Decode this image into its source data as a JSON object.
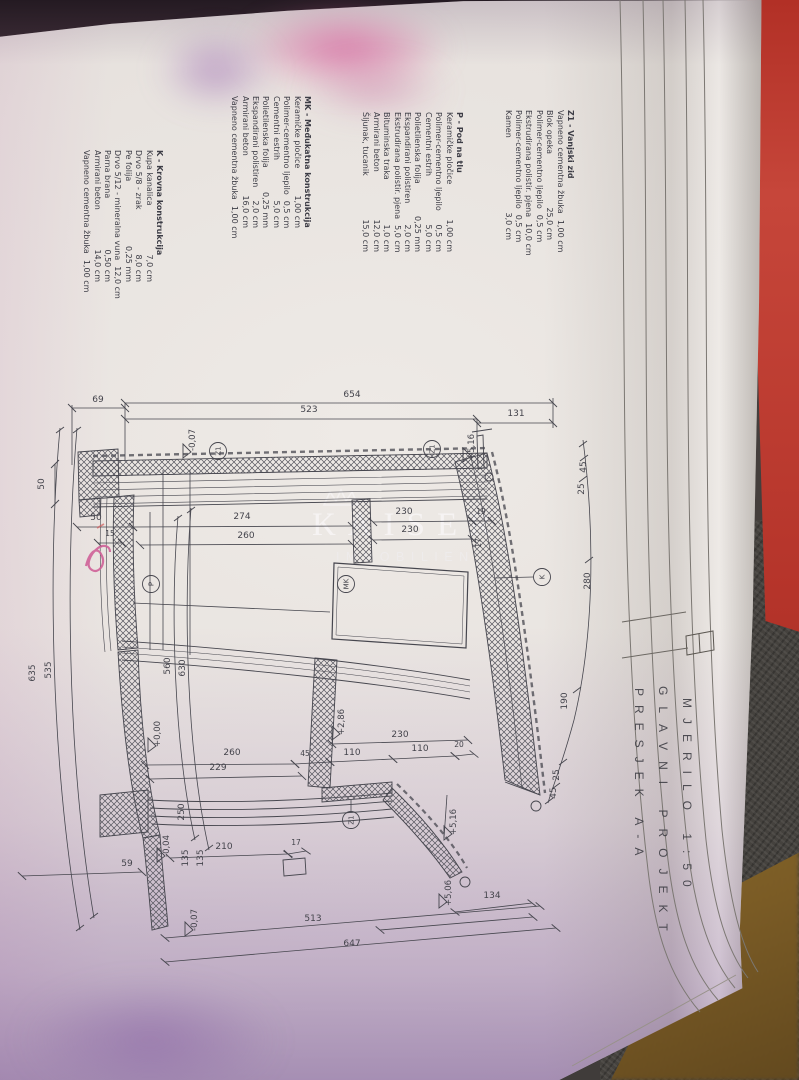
{
  "title_block": {
    "line1": "PRESJEK A-A",
    "line2": "GLAVNI PROJEKT",
    "line3": "MJERILO 1:50"
  },
  "watermark": {
    "line1": "KAISER",
    "line2": "IMMOBILIEN"
  },
  "annotations": {
    "handwritten_mark": "pink pen squiggle",
    "ink_color": "#cf6098"
  },
  "colors": {
    "paper": "#e9e5e1",
    "line": "#46464e",
    "cover_red": "#b5342a",
    "carpet": "#45423e",
    "fabric": "#8a672a"
  },
  "legend": {
    "blocks": [
      {
        "id": "k",
        "header": "K - Krovna konstrukcija",
        "items": [
          [
            "Kupa kanalica",
            "7,0 cm"
          ],
          [
            "Drvo 5/8 - zrak",
            "8,0 cm"
          ],
          [
            "Pe folija",
            "0,25 mm"
          ],
          [
            "Drvo 5/12 - mineralna vuna",
            "12,0 cm"
          ],
          [
            "Parna brana",
            "0,50 cm"
          ],
          [
            "Armirani beton",
            "14,0 cm"
          ],
          [
            "Vapneno cementna žbuka",
            "1,00 cm"
          ]
        ]
      },
      {
        "id": "mk",
        "header": "MK - Međukatna konstrukcija",
        "items": [
          [
            "Keramičke pločice",
            "1,00 cm"
          ],
          [
            "Polimer-cementno ljepilo",
            "0,5 cm"
          ],
          [
            "Cementni estrih",
            "5,0 cm"
          ],
          [
            "Polietilenska folija",
            "0,25 mm"
          ],
          [
            "Ekspandirani polistiren",
            "2,0 cm"
          ],
          [
            "Armirani beton",
            "16,0 cm"
          ],
          [
            "Vapneno cementna žbuka",
            "1,00 cm"
          ]
        ]
      },
      {
        "id": "p",
        "header": "P - Pod na tlu",
        "items": [
          [
            "Keramičke pločice",
            "1,00 cm"
          ],
          [
            "Polimer-cementno ljepilo",
            "0,5 cm"
          ],
          [
            "Cementni estrih",
            "5,0 cm"
          ],
          [
            "Polietilenska folija",
            "0,25 mm"
          ],
          [
            "Ekspandirani polistiren",
            "2,0 cm"
          ],
          [
            "Ekstrudirana polistir. pjena",
            "5,0 cm"
          ],
          [
            "Bituminska traka",
            "1,0 cm"
          ],
          [
            "Armirani beton",
            "12,0 cm"
          ],
          [
            "Šljunak, tucanik",
            "15,0 cm"
          ]
        ]
      },
      {
        "id": "z1",
        "header": "Z1 - Vanjski zid",
        "items": [
          [
            "Vapneno cementna žbuka",
            "1,00 cm"
          ],
          [
            "Blok opeka",
            "25,0 cm"
          ],
          [
            "Polimer-cementno ljepilo",
            "0,5 cm"
          ],
          [
            "Ekstrudirana polistir. pjena",
            "10,0 cm"
          ],
          [
            "Polimer-cementno ljepilo",
            "0,5 cm"
          ],
          [
            "Kamen",
            "3,0 cm"
          ]
        ]
      }
    ]
  },
  "drawing": {
    "markers": [
      {
        "t": "Z1",
        "x": 218,
        "y": 451
      },
      {
        "t": "Z1",
        "x": 432,
        "y": 449
      },
      {
        "t": "Z1",
        "x": 351,
        "y": 820
      },
      {
        "t": "P",
        "x": 151,
        "y": 584
      },
      {
        "t": "MK",
        "x": 346,
        "y": 584
      },
      {
        "t": "K",
        "x": 542,
        "y": 577
      }
    ],
    "labels": [
      {
        "t": "654",
        "x": 352,
        "y": 397,
        "r": 0
      },
      {
        "t": "69",
        "x": 98,
        "y": 402,
        "r": 0
      },
      {
        "t": "523",
        "x": 309,
        "y": 412,
        "r": 0
      },
      {
        "t": "131",
        "x": 516,
        "y": 416,
        "r": 0
      },
      {
        "t": "50",
        "x": 96,
        "y": 520,
        "r": 0
      },
      {
        "t": "274",
        "x": 242,
        "y": 519,
        "r": 0
      },
      {
        "t": "15",
        "x": 110,
        "y": 536,
        "r": 0,
        "fs": 7.5
      },
      {
        "t": "260",
        "x": 246,
        "y": 538,
        "r": 0
      },
      {
        "t": "230",
        "x": 404,
        "y": 514,
        "r": 0
      },
      {
        "t": "19",
        "x": 481,
        "y": 514,
        "r": 0,
        "fs": 7.5
      },
      {
        "t": "230",
        "x": 410,
        "y": 532,
        "r": 0
      },
      {
        "t": "230",
        "x": 400,
        "y": 737,
        "r": 0
      },
      {
        "t": "110",
        "x": 352,
        "y": 755,
        "r": 0
      },
      {
        "t": "110",
        "x": 420,
        "y": 751,
        "r": 0
      },
      {
        "t": "20",
        "x": 459,
        "y": 747,
        "r": 0,
        "fs": 7.5
      },
      {
        "t": "45",
        "x": 305,
        "y": 756,
        "r": 0,
        "fs": 7.5
      },
      {
        "t": "260",
        "x": 232,
        "y": 755,
        "r": 0
      },
      {
        "t": "229",
        "x": 218,
        "y": 770,
        "r": 0
      },
      {
        "t": "210",
        "x": 224,
        "y": 849,
        "r": 0
      },
      {
        "t": "17",
        "x": 296,
        "y": 845,
        "r": 0,
        "fs": 7.5
      },
      {
        "t": "59",
        "x": 127,
        "y": 866,
        "r": 0
      },
      {
        "t": "513",
        "x": 313,
        "y": 921,
        "r": 0
      },
      {
        "t": "647",
        "x": 352,
        "y": 946,
        "r": 0
      },
      {
        "t": "134",
        "x": 492,
        "y": 898,
        "r": 0
      },
      {
        "t": "50",
        "x": 44,
        "y": 484,
        "r": -90
      },
      {
        "t": "560",
        "x": 170,
        "y": 666,
        "r": -90
      },
      {
        "t": "630",
        "x": 185,
        "y": 668,
        "r": -90
      },
      {
        "t": "635",
        "x": 35,
        "y": 673,
        "r": -90
      },
      {
        "t": "535",
        "x": 51,
        "y": 670,
        "r": -90
      },
      {
        "t": "45",
        "x": 586,
        "y": 467,
        "r": -90
      },
      {
        "t": "25",
        "x": 584,
        "y": 489,
        "r": -90
      },
      {
        "t": "280",
        "x": 590,
        "y": 581,
        "r": -90
      },
      {
        "t": "190",
        "x": 567,
        "y": 701,
        "r": -90
      },
      {
        "t": "25",
        "x": 559,
        "y": 775,
        "r": -90
      },
      {
        "t": "45",
        "x": 556,
        "y": 793,
        "r": -90
      },
      {
        "t": "250",
        "x": 184,
        "y": 812,
        "r": -90
      },
      {
        "t": "135",
        "x": 188,
        "y": 858,
        "r": -90
      },
      {
        "t": "135",
        "x": 203,
        "y": 858,
        "r": -90
      },
      {
        "t": "17",
        "x": 481,
        "y": 543,
        "r": -90,
        "fs": 7.5
      },
      {
        "t": "-0,07",
        "x": 195,
        "y": 440,
        "r": -90,
        "fs": 8.5
      },
      {
        "t": "+5,16",
        "x": 474,
        "y": 447,
        "r": -90,
        "fs": 8.5
      },
      {
        "t": "+0,00",
        "x": 160,
        "y": 734,
        "r": -90,
        "fs": 8.5
      },
      {
        "t": "+2,86",
        "x": 344,
        "y": 722,
        "r": -90,
        "fs": 8.5
      },
      {
        "t": "+5,16",
        "x": 456,
        "y": 822,
        "r": -90,
        "fs": 8.5
      },
      {
        "t": "-0,04",
        "x": 169,
        "y": 846,
        "r": -90,
        "fs": 8.5
      },
      {
        "t": "-0,07",
        "x": 197,
        "y": 920,
        "r": -90,
        "fs": 8.5
      },
      {
        "t": "+5,06",
        "x": 451,
        "y": 893,
        "r": -90,
        "fs": 8.5
      }
    ],
    "lines": [
      [
        125,
        403,
        553,
        403,
        1
      ],
      [
        72,
        408,
        125,
        408,
        1
      ],
      [
        125,
        419,
        477,
        419,
        1
      ],
      [
        477,
        423,
        553,
        423,
        1
      ],
      [
        77,
        527,
        133,
        527,
        1
      ],
      [
        133,
        527,
        352,
        526,
        1
      ],
      [
        98,
        543,
        122,
        543,
        1
      ],
      [
        140,
        545,
        352,
        544,
        1
      ],
      [
        373,
        522,
        472,
        521,
        1
      ],
      [
        472,
        521,
        492,
        521,
        1
      ],
      [
        373,
        540,
        472,
        539,
        1
      ],
      [
        332,
        744,
        468,
        740,
        1
      ],
      [
        330,
        762,
        393,
        759,
        1
      ],
      [
        393,
        759,
        455,
        756,
        1
      ],
      [
        455,
        756,
        474,
        754,
        1
      ],
      [
        295,
        764,
        330,
        762,
        1
      ],
      [
        145,
        765,
        295,
        764,
        1
      ],
      [
        150,
        779,
        302,
        776,
        1
      ],
      [
        170,
        858,
        288,
        854,
        1
      ],
      [
        288,
        854,
        306,
        851,
        1
      ],
      [
        22,
        876,
        142,
        872,
        1
      ],
      [
        165,
        938,
        540,
        906,
        1
      ],
      [
        165,
        962,
        556,
        928,
        1
      ],
      [
        455,
        912,
        532,
        903,
        1
      ],
      [
        380,
        930,
        533,
        917,
        1
      ],
      [
        55,
        464,
        55,
        504,
        1
      ],
      [
        125,
        403,
        125,
        460,
        0
      ],
      [
        477,
        419,
        477,
        438,
        0
      ],
      [
        553,
        398,
        553,
        428,
        0
      ],
      [
        72,
        405,
        72,
        465,
        0
      ],
      [
        163,
        470,
        163,
        650,
        0
      ],
      [
        190,
        470,
        190,
        655,
        0
      ],
      [
        150,
        512,
        150,
        650,
        0
      ],
      [
        447,
        795,
        444,
        838,
        0
      ],
      [
        133,
        603,
        330,
        612,
        0
      ],
      [
        495,
        578,
        533,
        577,
        0
      ],
      [
        351,
        812,
        351,
        800,
        0
      ]
    ],
    "curves": [
      "M60,428 C48,560 50,760 80,930",
      "M77,428 C66,558 66,752 94,918",
      "M178,516 C170,610 174,746 195,840",
      "M191,508 C183,612 187,752 209,850",
      "M583,440 C596,540 593,640 574,720 C561,768 552,788 548,803"
    ],
    "ticks": [
      [
        60,
        430
      ],
      [
        80,
        928
      ],
      [
        77,
        430
      ],
      [
        94,
        916
      ],
      [
        178,
        518
      ],
      [
        195,
        838
      ],
      [
        191,
        510
      ],
      [
        209,
        848
      ],
      [
        583,
        444
      ],
      [
        584,
        458
      ],
      [
        583,
        479
      ],
      [
        589,
        560
      ],
      [
        577,
        690
      ],
      [
        563,
        762
      ],
      [
        556,
        786
      ],
      [
        549,
        801
      ]
    ],
    "flags": [
      [
        183,
        458
      ],
      [
        463,
        462
      ],
      [
        148,
        752
      ],
      [
        332,
        740
      ],
      [
        444,
        840
      ],
      [
        157,
        862
      ],
      [
        185,
        936
      ],
      [
        439,
        908
      ]
    ]
  }
}
